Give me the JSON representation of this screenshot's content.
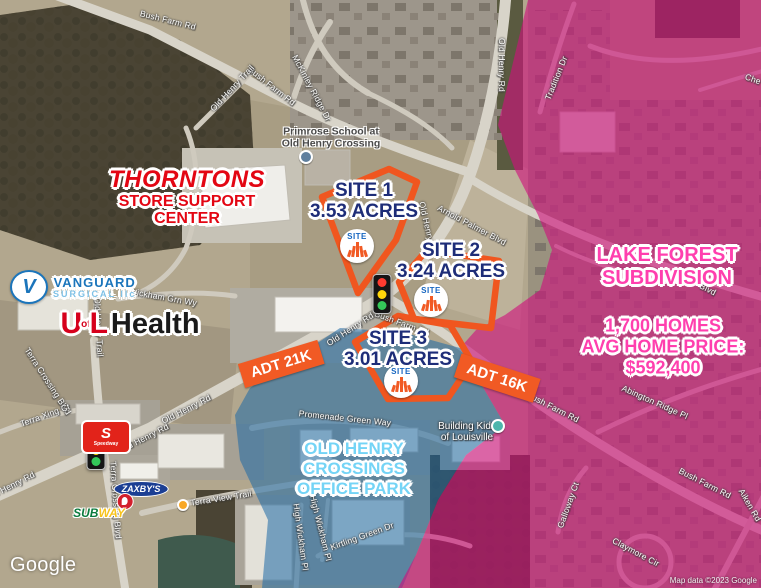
{
  "marker_text": "SITE",
  "sites": [
    {
      "label": "SITE 1",
      "acres": "3.53 ACRES"
    },
    {
      "label": "SITE 2",
      "acres": "3.24 ACRES"
    },
    {
      "label": "SITE 3",
      "acres": "3.01 ACRES"
    }
  ],
  "badges": [
    {
      "label": "ADT 21K"
    },
    {
      "label": "ADT 16K"
    }
  ],
  "lake_forest": {
    "l1": "LAKE FOREST",
    "l2": "SUBDIVISION",
    "s1": "1,700 HOMES",
    "s2": "AVG HOME PRICE:",
    "s3": "$592,400"
  },
  "office_park": {
    "l1": "OLD HENRY",
    "l2": "CROSSINGS",
    "l3": "OFFICE PARK"
  },
  "landmarks": {
    "thorntons_title": "THORNTONS",
    "thorntons_sub1": "STORE SUPPORT",
    "thorntons_sub2": "CENTER",
    "vanguard_v": "V",
    "vanguard_name": "VANGUARD",
    "vanguard_sub": "SURGICAL llc",
    "uofl_u": "U",
    "uofl_of": "of",
    "uofl_l": "L",
    "uofl_health": "Health",
    "primrose_line1": "Primrose School at",
    "primrose_line2": "Old Henry Crossing",
    "building_kidz_line1": "Building Kidz",
    "building_kidz_line2": "of Louisville",
    "zaxbys": "ZAXBY'S",
    "subway_sub": "SUB",
    "subway_way": "WAY",
    "speedway_s": "S",
    "speedway_name": "Speedway"
  },
  "attribution": {
    "logo": "Google",
    "text": "Map data ©2023 Google"
  },
  "colors": {
    "site_orange": "#f15a24",
    "site_navy": "#1e2d78",
    "overlay_pink": "#ce107c",
    "overlay_blue": "#1e69a5",
    "pink_text": "#ff3fae",
    "blue_text": "#74d4f6"
  },
  "road_labels": [
    {
      "text": "Bush Farm Rd",
      "x": 168,
      "y": 20,
      "rot": 14
    },
    {
      "text": "Bush Farm Rd",
      "x": 272,
      "y": 86,
      "rot": 38
    },
    {
      "text": "Old Henry Trail",
      "x": 232,
      "y": 88,
      "rot": -47
    },
    {
      "text": "McKinley Ridge Dr",
      "x": 312,
      "y": 88,
      "rot": 62
    },
    {
      "text": "Old Henry Rd",
      "x": 502,
      "y": 65,
      "rot": 90
    },
    {
      "text": "Tradition Dr",
      "x": 556,
      "y": 78,
      "rot": -68
    },
    {
      "text": "Che",
      "x": 753,
      "y": 79,
      "rot": 20
    },
    {
      "text": "Old Henry Rd",
      "x": 428,
      "y": 228,
      "rot": 77
    },
    {
      "text": "Arnold Palmer Blvd",
      "x": 472,
      "y": 225,
      "rot": 28
    },
    {
      "text": "Blvd",
      "x": 708,
      "y": 289,
      "rot": 28
    },
    {
      "text": "Old Henry Rd",
      "x": 350,
      "y": 329,
      "rot": -33
    },
    {
      "text": "Bush Farm Rd",
      "x": 402,
      "y": 323,
      "rot": 20
    },
    {
      "text": "Old Henry Rd",
      "x": 186,
      "y": 409,
      "rot": -27
    },
    {
      "text": "Old Henry Rd",
      "x": 144,
      "y": 438,
      "rot": -27
    },
    {
      "text": "Old Henry Rd",
      "x": 10,
      "y": 486,
      "rot": -27
    },
    {
      "text": "Terra Crossing Blvd",
      "x": 48,
      "y": 381,
      "rot": 57
    },
    {
      "text": "Terra Crossing Blvd",
      "x": 116,
      "y": 500,
      "rot": 86
    },
    {
      "text": "Terra Xing Ct",
      "x": 45,
      "y": 415,
      "rot": -20
    },
    {
      "text": "Wickham Grn Wy",
      "x": 163,
      "y": 297,
      "rot": 10
    },
    {
      "text": "Old Henry Trail",
      "x": 99,
      "y": 327,
      "rot": 87
    },
    {
      "text": "Terra View Trail",
      "x": 221,
      "y": 498,
      "rot": -9
    },
    {
      "text": "Promenade Green Way",
      "x": 345,
      "y": 418,
      "rot": 6
    },
    {
      "text": "High Wickham Pl",
      "x": 301,
      "y": 537,
      "rot": 82
    },
    {
      "text": "High Wickham Pl",
      "x": 321,
      "y": 528,
      "rot": 76
    },
    {
      "text": "Kirtling Green Dr",
      "x": 362,
      "y": 536,
      "rot": -20
    },
    {
      "text": "Bush Farm Rd",
      "x": 553,
      "y": 407,
      "rot": 27
    },
    {
      "text": "Bush Farm Rd",
      "x": 705,
      "y": 483,
      "rot": 27
    },
    {
      "text": "Abington Ridge Pl",
      "x": 655,
      "y": 402,
      "rot": 24
    },
    {
      "text": "Galloway Ct",
      "x": 568,
      "y": 505,
      "rot": -70
    },
    {
      "text": "Claymore Cir",
      "x": 636,
      "y": 552,
      "rot": 28
    },
    {
      "text": "Aiken Rd",
      "x": 750,
      "y": 505,
      "rot": 60
    }
  ]
}
